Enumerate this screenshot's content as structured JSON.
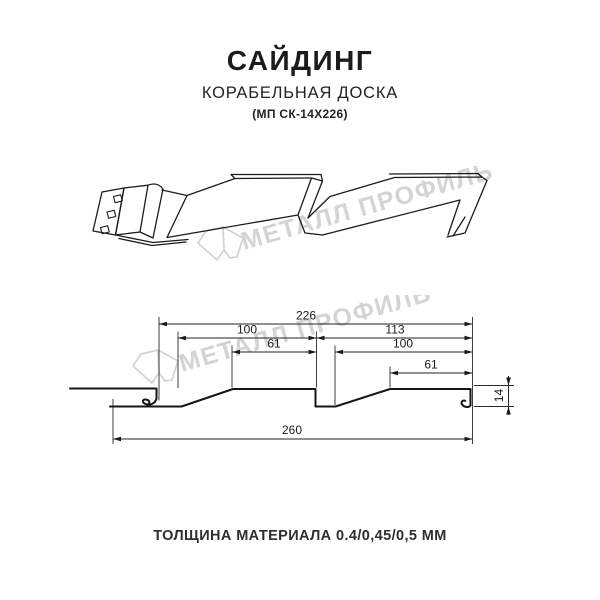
{
  "header": {
    "title": "САЙДИНГ",
    "subtitle": "КОРАБЕЛЬНАЯ ДОСКА",
    "model": "(МП СК-14Х226)"
  },
  "watermark": {
    "brand_text": "МЕТАЛЛ ПРОФИЛЬ"
  },
  "cross_section": {
    "dim_module_width": "226",
    "dim_left_panel_width": "100",
    "dim_left_flat_width": "61",
    "dim_right_module": "113",
    "dim_right_panel_width": "100",
    "dim_right_flat_width": "61",
    "dim_overall_width": "260",
    "dim_height": "14"
  },
  "footer": {
    "thickness_note": "ТОЛЩИНА МАТЕРИАЛА 0.4/0,45/0,5 ММ"
  }
}
